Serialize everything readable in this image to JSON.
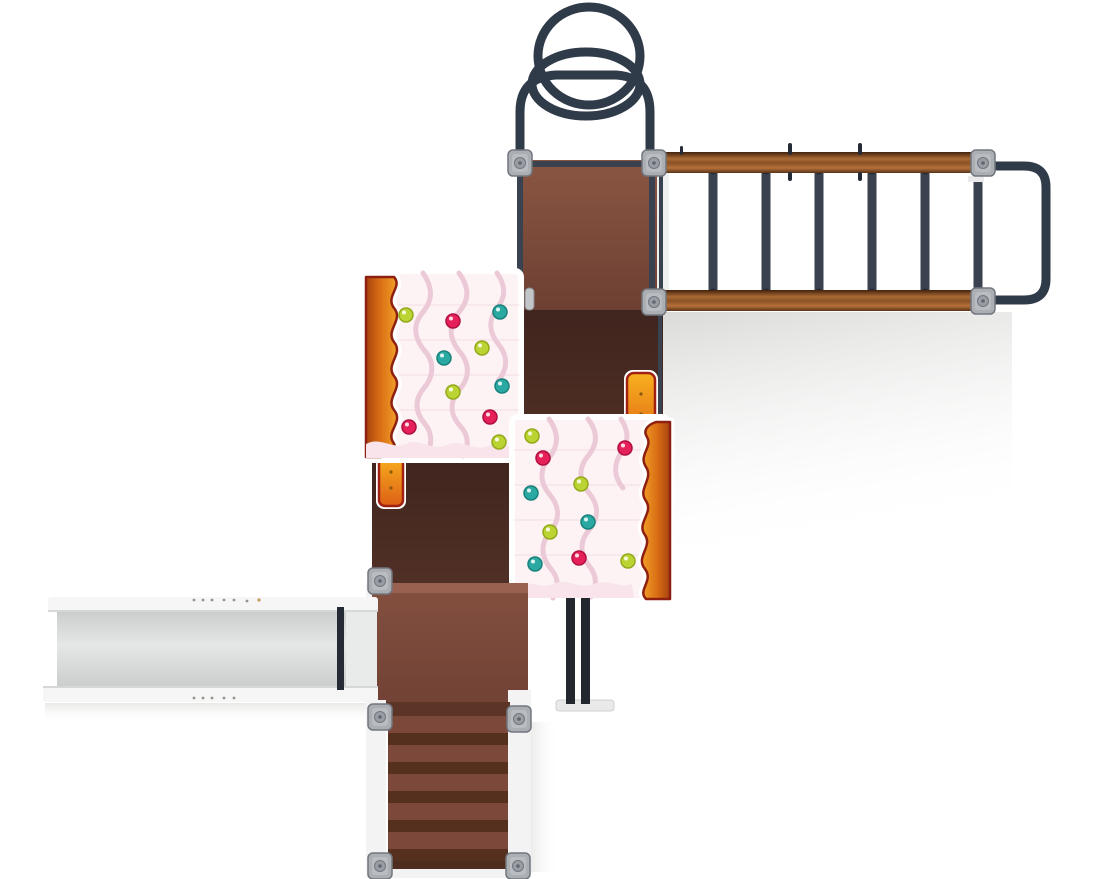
{
  "colors": {
    "bg": "#ffffff",
    "navy": "#39424e",
    "navy_dark": "#242b36",
    "tube": "#303b4a",
    "deck_a_top": "#8a5642",
    "deck_a_bottom": "#6d4033",
    "deck_b_top": "#845040",
    "deck_b_bottom": "#6f4134",
    "deck_highlight": "#996250",
    "dark_top": "#3f251e",
    "dark_bottom": "#633c2e",
    "wood_edge": "#3f230e",
    "wood_dark": "#6b3c1a",
    "wood_hi": "#a96a35",
    "wood_mid": "#8a5125",
    "wood_light": "#b5713a",
    "wood_low": "#5a3318",
    "clamp_fill": "#abaeb3",
    "clamp_inner": "#b9bcc1",
    "clamp_border": "#72767e",
    "clamp_bolt": "#999da4",
    "clamp_dot": "#62666e",
    "frosting": "#fdf3f5",
    "drip": "#ecc9d6",
    "frosting_band": "#f8e4ea",
    "frosting_line": "#f3dde4",
    "ginger_dark": "#a8430f",
    "ginger_mid": "#d96d15",
    "ginger_light": "#f2a128",
    "ginger_border": "#8e2012",
    "grip_light": "#f8b01e",
    "grip_dark": "#dd5f15",
    "grip_border": "#a02112",
    "slide_bed_edge": "#cbcdcc",
    "slide_bed_mid": "#e5e7e6",
    "rail_white": "#f5f6f5",
    "rail_edge": "#d6d8d7",
    "stair_tread": "#7c4839",
    "stair_riser": "#55301f",
    "stair_top_band": "#5c3526",
    "stair_bottom_band": "#4e2c1e",
    "stringer_white": "#f2f3f2",
    "post_black": "#23272e",
    "white": "#ffffff",
    "shadow_gray": "#d6d6d4"
  },
  "sprinkle_colors": {
    "lime": {
      "fill": "#bcd433",
      "stroke": "#94a91c"
    },
    "red": {
      "fill": "#e62059",
      "stroke": "#b01041"
    },
    "teal": {
      "fill": "#2aa9a2",
      "stroke": "#1a827c"
    }
  },
  "sprinkle_radius": 7,
  "panels": {
    "left": {
      "sprinkles": [
        {
          "x": 406,
          "y": 315,
          "color": "lime"
        },
        {
          "x": 453,
          "y": 321,
          "color": "red"
        },
        {
          "x": 500,
          "y": 312,
          "color": "teal"
        },
        {
          "x": 482,
          "y": 348,
          "color": "lime"
        },
        {
          "x": 444,
          "y": 358,
          "color": "teal"
        },
        {
          "x": 453,
          "y": 392,
          "color": "lime"
        },
        {
          "x": 502,
          "y": 386,
          "color": "teal"
        },
        {
          "x": 490,
          "y": 417,
          "color": "red"
        },
        {
          "x": 409,
          "y": 427,
          "color": "red"
        },
        {
          "x": 499,
          "y": 442,
          "color": "lime"
        }
      ]
    },
    "right": {
      "sprinkles": [
        {
          "x": 532,
          "y": 436,
          "color": "lime"
        },
        {
          "x": 543,
          "y": 458,
          "color": "red"
        },
        {
          "x": 625,
          "y": 448,
          "color": "red"
        },
        {
          "x": 581,
          "y": 484,
          "color": "lime"
        },
        {
          "x": 531,
          "y": 493,
          "color": "teal"
        },
        {
          "x": 588,
          "y": 522,
          "color": "teal"
        },
        {
          "x": 550,
          "y": 532,
          "color": "lime"
        },
        {
          "x": 579,
          "y": 558,
          "color": "red"
        },
        {
          "x": 535,
          "y": 564,
          "color": "teal"
        },
        {
          "x": 628,
          "y": 561,
          "color": "lime"
        }
      ]
    }
  },
  "monkey_bars": {
    "rung_count": 6,
    "rung_start_x": 713,
    "rung_spacing": 53,
    "rung_y1": 170,
    "rung_y2": 293,
    "rung_width": 9
  },
  "stairs": {
    "step_count": 5,
    "x": 388,
    "width": 120,
    "start_y": 716,
    "tread_height": 17,
    "riser_height": 12
  },
  "connectors": [
    [
      520,
      163
    ],
    [
      654,
      163
    ],
    [
      654,
      302
    ],
    [
      983,
      163
    ],
    [
      983,
      301
    ],
    [
      380,
      581
    ],
    [
      380,
      717
    ],
    [
      519,
      719
    ],
    [
      380,
      866
    ],
    [
      518,
      866
    ]
  ]
}
